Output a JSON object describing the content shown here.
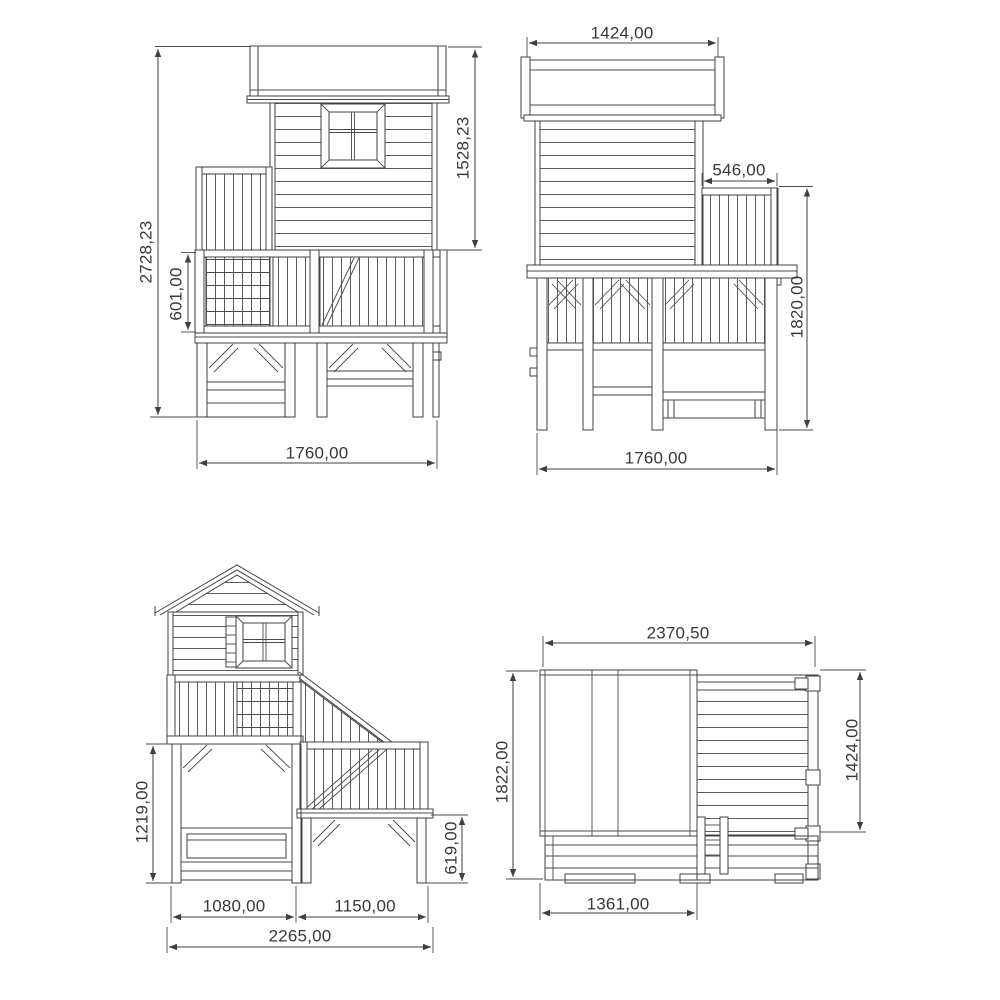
{
  "drawing": {
    "background": "#ffffff",
    "line_color": "#404040",
    "text_color": "#383838",
    "views": {
      "front": {
        "height_total": "2728,23",
        "height_house": "1528,23",
        "height_railing": "601,00",
        "width_base": "1760,00"
      },
      "side": {
        "width_roof": "1424,00",
        "width_balcony": "546,00",
        "height_railing_to_ground": "1820,00",
        "width_base": "1760,00"
      },
      "back_stairs": {
        "height_platform": "1219,00",
        "height_stair_platform": "619,00",
        "width_house_base": "1080,00",
        "width_stair_base": "1150,00",
        "width_total": "2265,00"
      },
      "plan": {
        "width_total": "2370,50",
        "depth_total": "1822,00",
        "depth_deck": "1424,00",
        "width_house": "1361,00"
      }
    }
  }
}
